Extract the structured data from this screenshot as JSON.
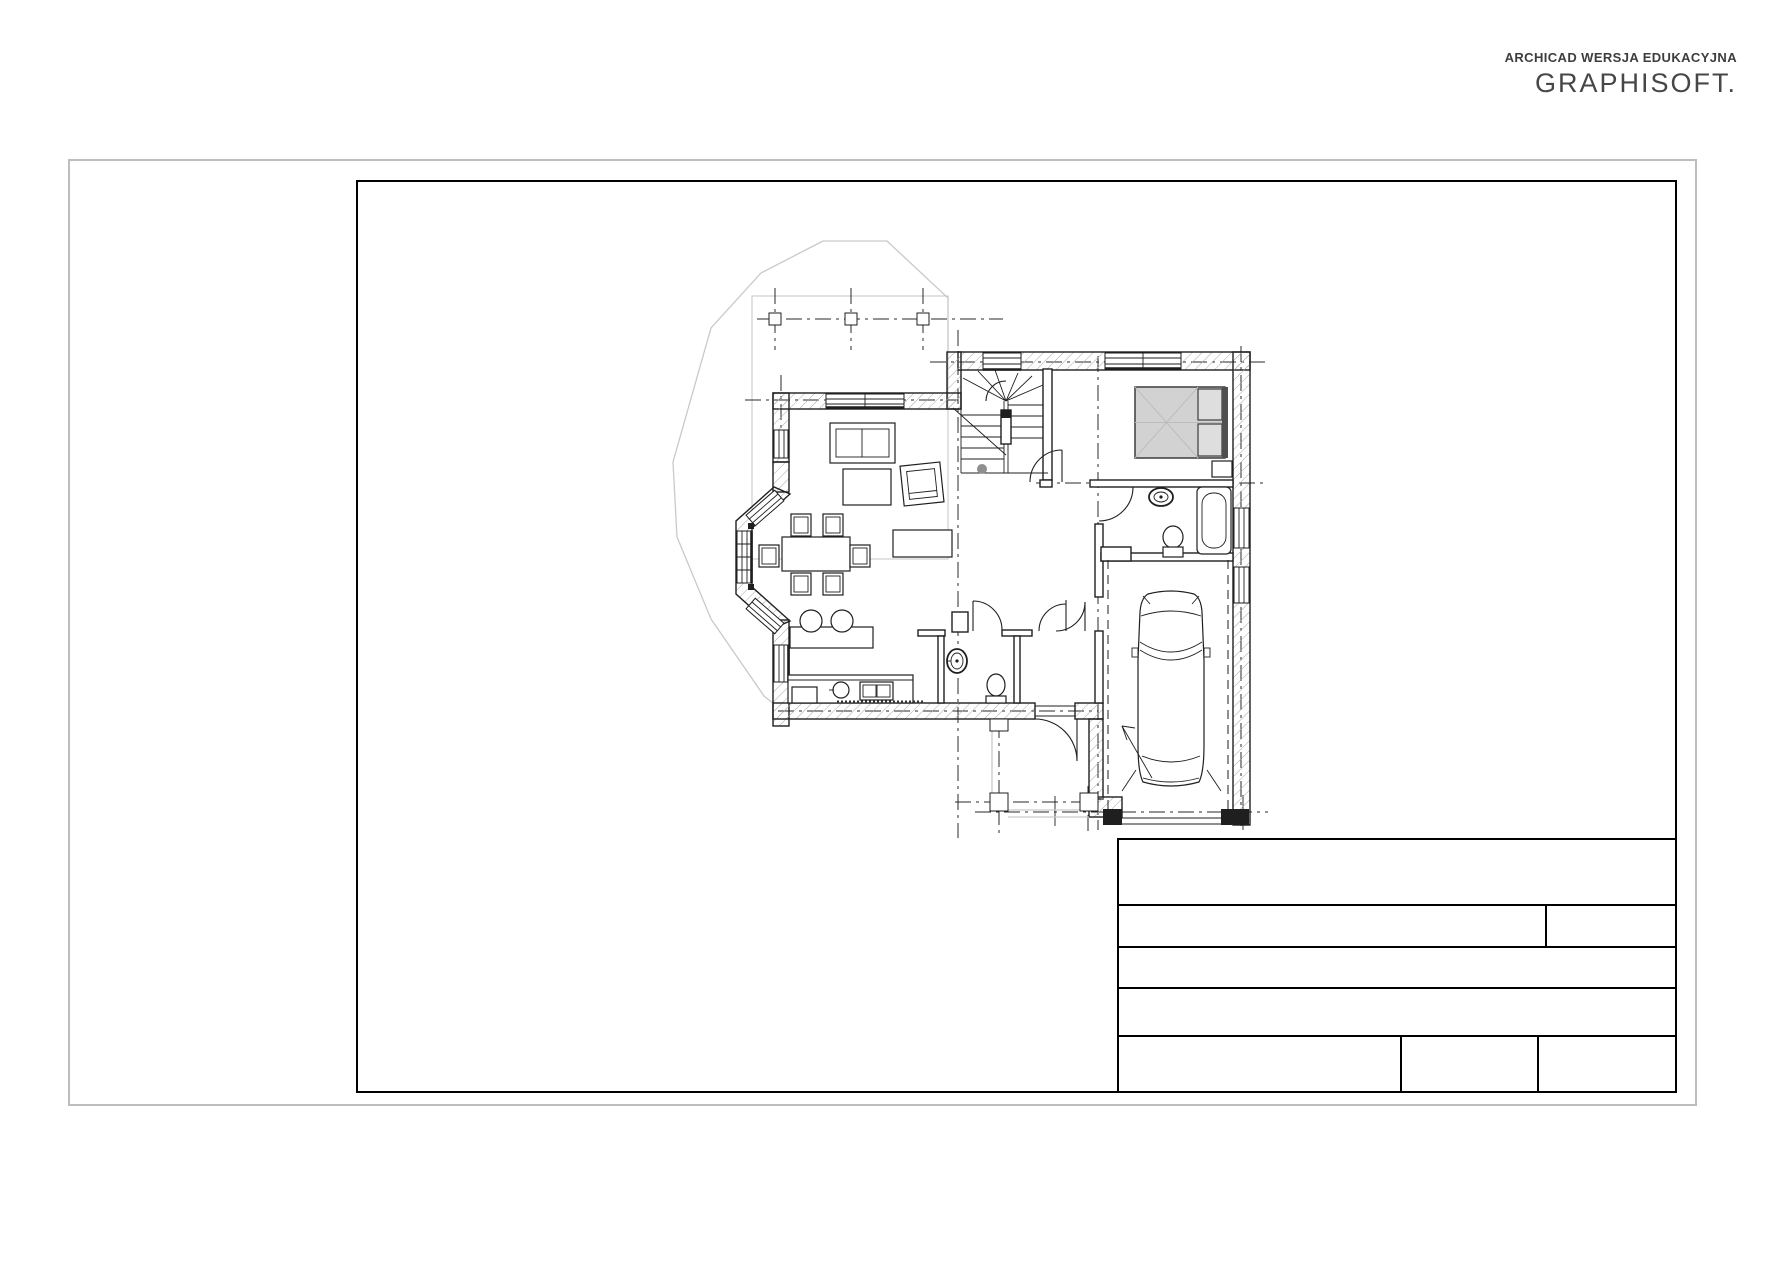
{
  "branding": {
    "edition_line": "ARCHICAD WERSJA EDUKACYJNA",
    "logo_text": "GRAPHISOFT."
  },
  "sheet": {
    "background": "#ffffff",
    "outer_border_color": "#bdbdbd",
    "frame_border_color": "#000000"
  },
  "title_block": {
    "cells": {
      "row1": "",
      "row2_left": "",
      "row2_right": "",
      "row3": "",
      "row4": "",
      "row5_left": "",
      "row5_middle": "",
      "row5_right": ""
    }
  },
  "floor_plan": {
    "line_color": "#1f1f1f",
    "hatch_color": "#a8a8a8",
    "roof_outline_color": "#c9c9c9",
    "upper_floor_outline_color": "#c4c4c4",
    "grid_line_color": "#2a2a2a",
    "bed_fill": "#d2d2d2",
    "pillow_fill": "#dedede",
    "headboard_fill": "#4f4f4f",
    "stair_dot_color": "#8f8f8f",
    "symbols": [
      "roof-outline",
      "upper-floor-outline",
      "column-grid-marker",
      "centerline",
      "winder-staircase",
      "double-bed",
      "nightstand",
      "bathroom-washbasin",
      "bathroom-toilet",
      "bathtub",
      "sofa",
      "armchair",
      "coffee-table",
      "tv-sideboard",
      "dining-table",
      "dining-chair",
      "kitchen-stool",
      "kitchen-counter",
      "kitchen-sink",
      "stove",
      "base-cabinet",
      "door-swing",
      "window",
      "wc-washbasin",
      "wc-toilet",
      "car",
      "garage-door-threshold",
      "entry-porch-column",
      "driveway-arrow",
      "entry-doormat"
    ]
  }
}
